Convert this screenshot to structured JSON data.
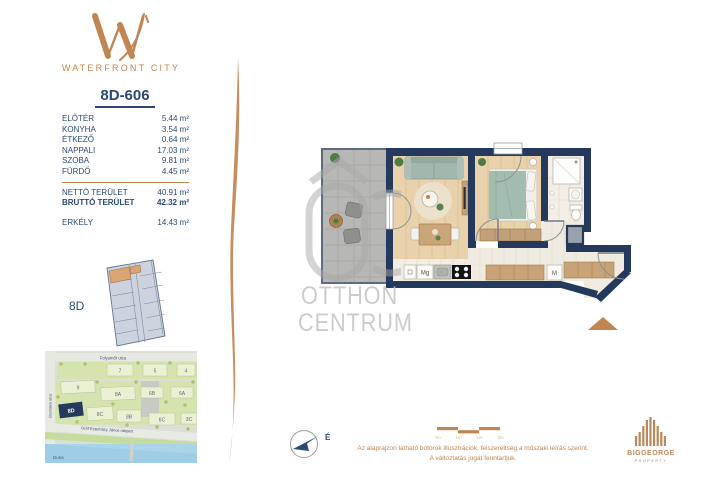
{
  "brand": {
    "name": "WATERFRONT CITY"
  },
  "unit": {
    "id": "8D-606",
    "rooms": [
      {
        "label": "ELŐTÉR",
        "area": "5.44 m²"
      },
      {
        "label": "KONYHA",
        "area": "3.54 m²"
      },
      {
        "label": "ÉTKEZŐ",
        "area": "0.64 m²"
      },
      {
        "label": "NAPPALI",
        "area": "17.03 m²"
      },
      {
        "label": "SZOBA",
        "area": "9.81 m²"
      },
      {
        "label": "FÜRDŐ",
        "area": "4.45 m²"
      }
    ],
    "net_label": "NETTÓ TERÜLET",
    "net_area": "40.91 m²",
    "gross_label": "BRUTTÓ TERÜLET",
    "gross_area": "42.32 m²",
    "balcony_label": "ERKÉLY",
    "balcony_area": "14.43 m²",
    "building": "8D"
  },
  "floorplan": {
    "labels": {
      "dishwasher": "Mg",
      "washer": "M"
    }
  },
  "watermark": {
    "line1": "OTTHON",
    "line2": "CENTRUM"
  },
  "map": {
    "street_top": "Folyamőr utca",
    "street_left": "Úszódaru utca",
    "street_diag": "Gróf Esterházy János rakpart",
    "river": "Duna",
    "buildings": [
      "7",
      "5",
      "4",
      "9",
      "8A",
      "6B",
      "6A",
      "8D",
      "8C",
      "8B",
      "6C",
      "3C"
    ]
  },
  "footer": {
    "north": "É",
    "scale": [
      "0m",
      "1m",
      "2m",
      "3m"
    ],
    "disclaimer_line1": "Az alaprajzon látható bútorok illusztrációk, felszereltség a műszaki leírás szerint.",
    "disclaimer_line2": "A változtatás jogát fenntartjuk.",
    "agency_name": "BIGGEORGE",
    "agency_sub": "PROPERTY"
  },
  "colors": {
    "copper": "#c08552",
    "navy": "#2b4a73",
    "wall": "#24395c",
    "bed_green": "#a3bcb0"
  }
}
